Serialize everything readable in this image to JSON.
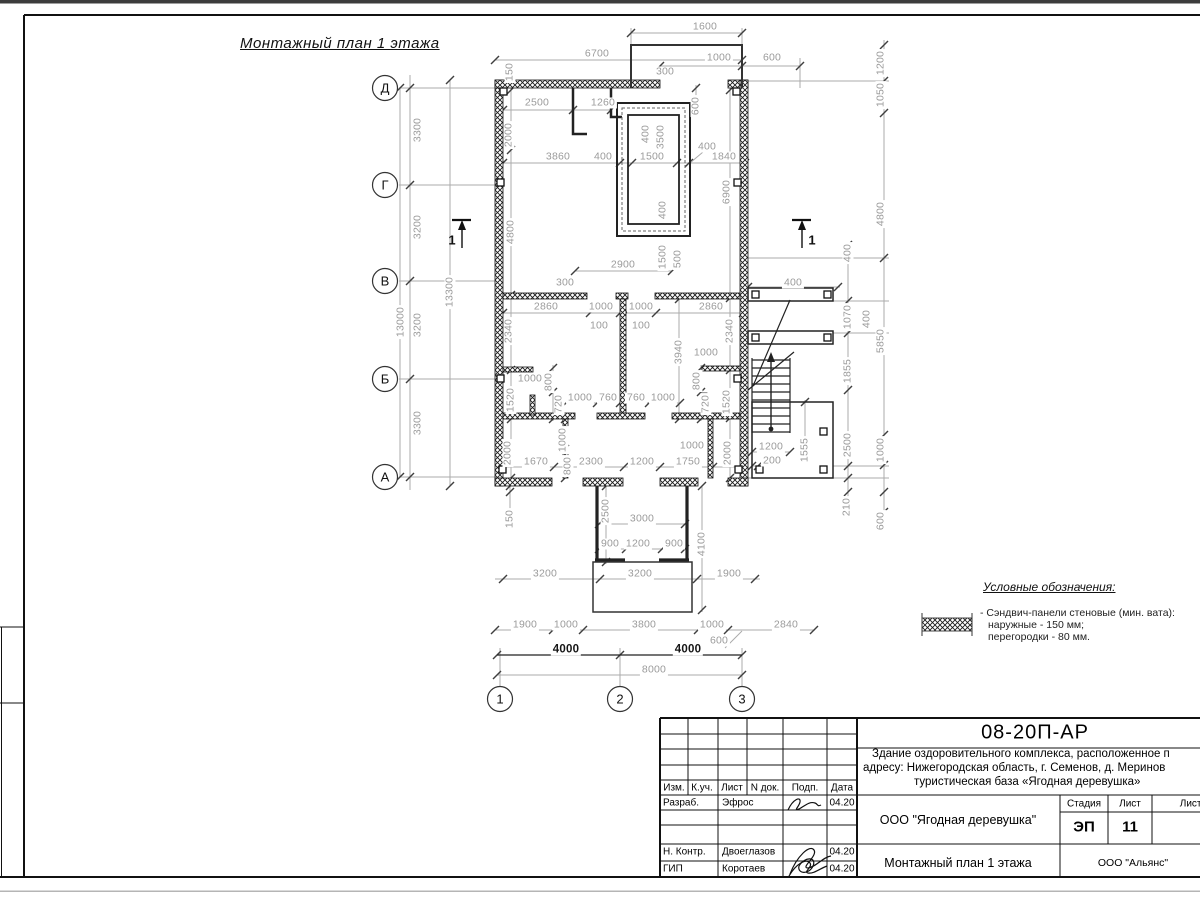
{
  "sheet": {
    "title": "Монтажный план 1 этажа"
  },
  "legend": {
    "heading": "Условные обозначения:",
    "items": [
      "- Сэндвич-панели стеновые (мин. вата):",
      "наружные - 150 мм;",
      "перегородки - 80 мм."
    ]
  },
  "plan": {
    "axes_rows": [
      {
        "label": "Д",
        "x": 385,
        "y": 88
      },
      {
        "label": "Г",
        "x": 385,
        "y": 185
      },
      {
        "label": "В",
        "x": 385,
        "y": 281
      },
      {
        "label": "Б",
        "x": 385,
        "y": 379
      },
      {
        "label": "А",
        "x": 385,
        "y": 477
      }
    ],
    "axes_cols": [
      {
        "label": "1",
        "x": 500,
        "y": 699
      },
      {
        "label": "2",
        "x": 620,
        "y": 699
      },
      {
        "label": "3",
        "x": 742,
        "y": 699
      }
    ],
    "sections": [
      {
        "label": "1",
        "x": 452,
        "y": 240
      },
      {
        "label": "1",
        "x": 812,
        "y": 240
      }
    ],
    "dimensions": [
      {
        "t": "1600",
        "x": 705,
        "y": 27,
        "r": 0
      },
      {
        "t": "6700",
        "x": 597,
        "y": 54,
        "r": 0
      },
      {
        "t": "1000",
        "x": 719,
        "y": 58,
        "r": 0
      },
      {
        "t": "600",
        "x": 772,
        "y": 58,
        "r": 0
      },
      {
        "t": "300",
        "x": 665,
        "y": 72,
        "r": 0
      },
      {
        "t": "150",
        "x": 510,
        "y": 72,
        "r": 1
      },
      {
        "t": "2500",
        "x": 537,
        "y": 103,
        "r": 0
      },
      {
        "t": "1260",
        "x": 603,
        "y": 103,
        "r": 0
      },
      {
        "t": "2000",
        "x": 509,
        "y": 135,
        "r": 1
      },
      {
        "t": "600",
        "x": 696,
        "y": 106,
        "r": 1
      },
      {
        "t": "400",
        "x": 646,
        "y": 134,
        "r": 1
      },
      {
        "t": "3500",
        "x": 661,
        "y": 137,
        "r": 1
      },
      {
        "t": "3860",
        "x": 558,
        "y": 157,
        "r": 0
      },
      {
        "t": "400",
        "x": 603,
        "y": 157,
        "r": 0
      },
      {
        "t": "1500",
        "x": 652,
        "y": 157,
        "r": 0
      },
      {
        "t": "400",
        "x": 707,
        "y": 147,
        "r": 0
      },
      {
        "t": "1840",
        "x": 724,
        "y": 157,
        "r": 0
      },
      {
        "t": "4800",
        "x": 511,
        "y": 232,
        "r": 1
      },
      {
        "t": "6900",
        "x": 727,
        "y": 192,
        "r": 1
      },
      {
        "t": "400",
        "x": 663,
        "y": 210,
        "r": 1
      },
      {
        "t": "1200",
        "x": 881,
        "y": 63,
        "r": 1
      },
      {
        "t": "1050",
        "x": 881,
        "y": 95,
        "r": 1
      },
      {
        "t": "4800",
        "x": 881,
        "y": 214,
        "r": 1
      },
      {
        "t": "400",
        "x": 848,
        "y": 253,
        "r": 1
      },
      {
        "t": "2900",
        "x": 623,
        "y": 265,
        "r": 0
      },
      {
        "t": "1500",
        "x": 663,
        "y": 257,
        "r": 1
      },
      {
        "t": "500",
        "x": 678,
        "y": 259,
        "r": 1
      },
      {
        "t": "300",
        "x": 565,
        "y": 283,
        "r": 0
      },
      {
        "t": "2860",
        "x": 546,
        "y": 307,
        "r": 0
      },
      {
        "t": "1000",
        "x": 601,
        "y": 307,
        "r": 0
      },
      {
        "t": "1000",
        "x": 641,
        "y": 307,
        "r": 0
      },
      {
        "t": "2860",
        "x": 711,
        "y": 307,
        "r": 0
      },
      {
        "t": "100",
        "x": 599,
        "y": 326,
        "r": 0
      },
      {
        "t": "100",
        "x": 641,
        "y": 326,
        "r": 0
      },
      {
        "t": "2340",
        "x": 509,
        "y": 331,
        "r": 1
      },
      {
        "t": "2340",
        "x": 730,
        "y": 331,
        "r": 1
      },
      {
        "t": "3940",
        "x": 679,
        "y": 352,
        "r": 1
      },
      {
        "t": "1000",
        "x": 706,
        "y": 353,
        "r": 0
      },
      {
        "t": "1000",
        "x": 530,
        "y": 379,
        "r": 0
      },
      {
        "t": "800",
        "x": 549,
        "y": 382,
        "r": 1
      },
      {
        "t": "720",
        "x": 559,
        "y": 404,
        "r": 1
      },
      {
        "t": "800",
        "x": 697,
        "y": 381,
        "r": 1
      },
      {
        "t": "720",
        "x": 706,
        "y": 404,
        "r": 1
      },
      {
        "t": "1520",
        "x": 511,
        "y": 400,
        "r": 1
      },
      {
        "t": "1520",
        "x": 727,
        "y": 402,
        "r": 1
      },
      {
        "t": "1000",
        "x": 580,
        "y": 398,
        "r": 0
      },
      {
        "t": "760",
        "x": 608,
        "y": 398,
        "r": 0
      },
      {
        "t": "760",
        "x": 636,
        "y": 398,
        "r": 0
      },
      {
        "t": "1000",
        "x": 663,
        "y": 398,
        "r": 0
      },
      {
        "t": "1000",
        "x": 563,
        "y": 440,
        "r": 1
      },
      {
        "t": "800",
        "x": 568,
        "y": 466,
        "r": 1
      },
      {
        "t": "2000",
        "x": 508,
        "y": 453,
        "r": 1
      },
      {
        "t": "2000",
        "x": 728,
        "y": 453,
        "r": 1
      },
      {
        "t": "1000",
        "x": 692,
        "y": 446,
        "r": 0
      },
      {
        "t": "1670",
        "x": 536,
        "y": 462,
        "r": 0
      },
      {
        "t": "2300",
        "x": 591,
        "y": 462,
        "r": 0
      },
      {
        "t": "1200",
        "x": 642,
        "y": 462,
        "r": 0
      },
      {
        "t": "1750",
        "x": 688,
        "y": 462,
        "r": 0
      },
      {
        "t": "150",
        "x": 510,
        "y": 519,
        "r": 1
      },
      {
        "t": "2500",
        "x": 606,
        "y": 511,
        "r": 1
      },
      {
        "t": "3000",
        "x": 642,
        "y": 519,
        "r": 0
      },
      {
        "t": "4100",
        "x": 702,
        "y": 544,
        "r": 1
      },
      {
        "t": "900",
        "x": 610,
        "y": 544,
        "r": 0
      },
      {
        "t": "1200",
        "x": 638,
        "y": 544,
        "r": 0
      },
      {
        "t": "900",
        "x": 674,
        "y": 544,
        "r": 0
      },
      {
        "t": "3200",
        "x": 545,
        "y": 574,
        "r": 0
      },
      {
        "t": "3200",
        "x": 640,
        "y": 574,
        "r": 0
      },
      {
        "t": "1900",
        "x": 729,
        "y": 574,
        "r": 0
      },
      {
        "t": "1900",
        "x": 525,
        "y": 625,
        "r": 0
      },
      {
        "t": "1000",
        "x": 566,
        "y": 625,
        "r": 0
      },
      {
        "t": "3800",
        "x": 644,
        "y": 625,
        "r": 0
      },
      {
        "t": "1000",
        "x": 712,
        "y": 625,
        "r": 0
      },
      {
        "t": "2840",
        "x": 786,
        "y": 625,
        "r": 0
      },
      {
        "t": "600",
        "x": 719,
        "y": 641,
        "r": 0
      },
      {
        "t": "4000",
        "x": 566,
        "y": 650,
        "r": 0,
        "k": "dark"
      },
      {
        "t": "4000",
        "x": 688,
        "y": 650,
        "r": 0,
        "k": "dark"
      },
      {
        "t": "8000",
        "x": 654,
        "y": 670,
        "r": 0
      },
      {
        "t": "400",
        "x": 793,
        "y": 283,
        "r": 0
      },
      {
        "t": "1070",
        "x": 848,
        "y": 317,
        "r": 1
      },
      {
        "t": "400",
        "x": 867,
        "y": 319,
        "r": 1
      },
      {
        "t": "5850",
        "x": 881,
        "y": 341,
        "r": 1
      },
      {
        "t": "1855",
        "x": 848,
        "y": 371,
        "r": 1
      },
      {
        "t": "2500",
        "x": 848,
        "y": 445,
        "r": 1
      },
      {
        "t": "1000",
        "x": 881,
        "y": 450,
        "r": 1
      },
      {
        "t": "1555",
        "x": 805,
        "y": 450,
        "r": 1
      },
      {
        "t": "1200",
        "x": 771,
        "y": 447,
        "r": 0
      },
      {
        "t": "200",
        "x": 772,
        "y": 461,
        "r": 0
      },
      {
        "t": "210",
        "x": 847,
        "y": 507,
        "r": 1
      },
      {
        "t": "600",
        "x": 881,
        "y": 521,
        "r": 1
      },
      {
        "t": "3300",
        "x": 418,
        "y": 130,
        "r": 1
      },
      {
        "t": "3200",
        "x": 418,
        "y": 227,
        "r": 1
      },
      {
        "t": "3200",
        "x": 418,
        "y": 325,
        "r": 1
      },
      {
        "t": "3300",
        "x": 418,
        "y": 423,
        "r": 1
      },
      {
        "t": "13000",
        "x": 401,
        "y": 322,
        "r": 1
      },
      {
        "t": "13300",
        "x": 450,
        "y": 292,
        "r": 1
      }
    ]
  },
  "titleblock": {
    "doc_number": "08-20П-АР",
    "description_lines": [
      "Здание оздоровительного комплекса, расположенное п",
      "адресу: Нижегородская область, г. Семенов, д. Меринов",
      "туристическая база «Ягодная деревушка»"
    ],
    "cols": {
      "izm": "Изм.",
      "kuch": "К.уч.",
      "list": "Лист",
      "ndok": "N док.",
      "podp": "Подп.",
      "data": "Дата"
    },
    "rows": [
      {
        "role": "Разраб.",
        "name": "Эфрос",
        "date": "04.20"
      },
      {
        "role": "Н. Контр.",
        "name": "Двоеглазов",
        "date": "04.20"
      },
      {
        "role": "ГИП",
        "name": "Коротаев",
        "date": "04.20"
      }
    ],
    "org_customer": "ООО \"Ягодная деревушка\"",
    "stage_label": "Стадия",
    "sheet_label": "Лист",
    "sheets_label": "Листов",
    "stage_value": "ЭП",
    "sheet_value": "11",
    "drawing_name": "Монтажный план 1 этажа",
    "org_contractor": "ООО \"Альянс\""
  }
}
